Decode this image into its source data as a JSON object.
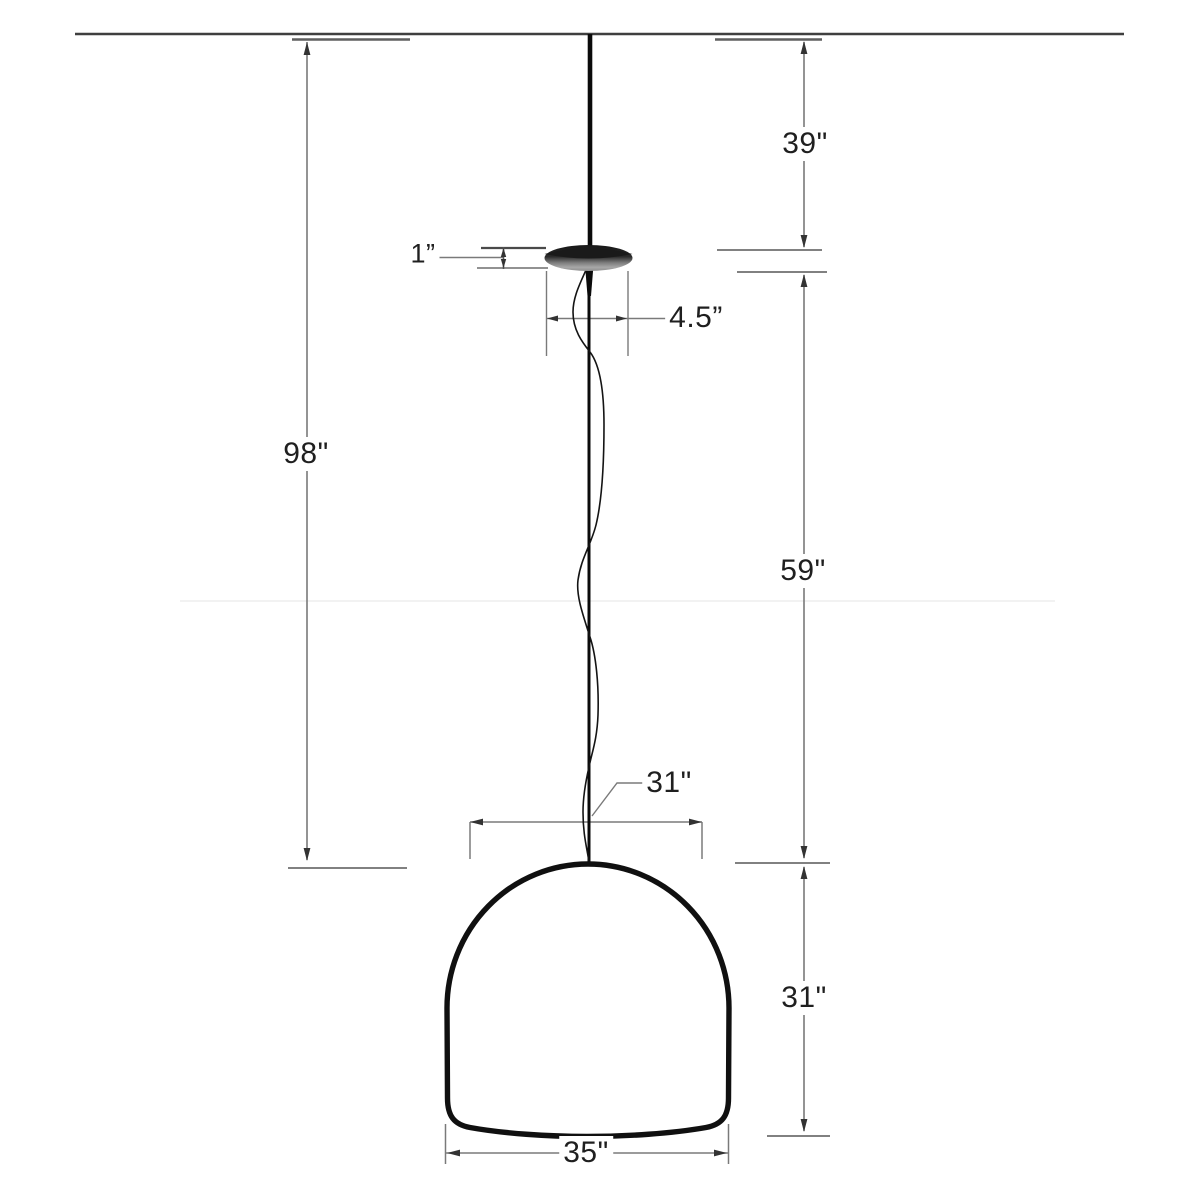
{
  "title": "Pendant lamp dimension diagram",
  "canvas": {
    "width": 1200,
    "height": 1200,
    "background": "#ffffff"
  },
  "colors": {
    "outline": "#101010",
    "dimension_line": "#7a7a7a",
    "terminal_line": "#5f5f5f",
    "arrow": "#333333",
    "text": "#1f1f1f",
    "ceiling_line": "#3f3f3f",
    "canopy_dark": "#1a1a1a",
    "canopy_light": "#9c9c9c"
  },
  "diagram": {
    "parts": [
      {
        "id": "ceiling-line"
      },
      {
        "id": "suspension-cord"
      },
      {
        "id": "canopy"
      },
      {
        "id": "safety-wire"
      },
      {
        "id": "shade"
      }
    ],
    "dimensions": [
      {
        "id": "overall-drop",
        "label": "98\""
      },
      {
        "id": "upper-cord",
        "label": "39\""
      },
      {
        "id": "canopy-height",
        "label": "1”"
      },
      {
        "id": "canopy-diameter",
        "label": "4.5”"
      },
      {
        "id": "lower-cord",
        "label": "59\""
      },
      {
        "id": "shade-top-width",
        "label": "31\""
      },
      {
        "id": "shade-height",
        "label": "31\""
      },
      {
        "id": "shade-bottom-width",
        "label": "35\""
      }
    ]
  }
}
